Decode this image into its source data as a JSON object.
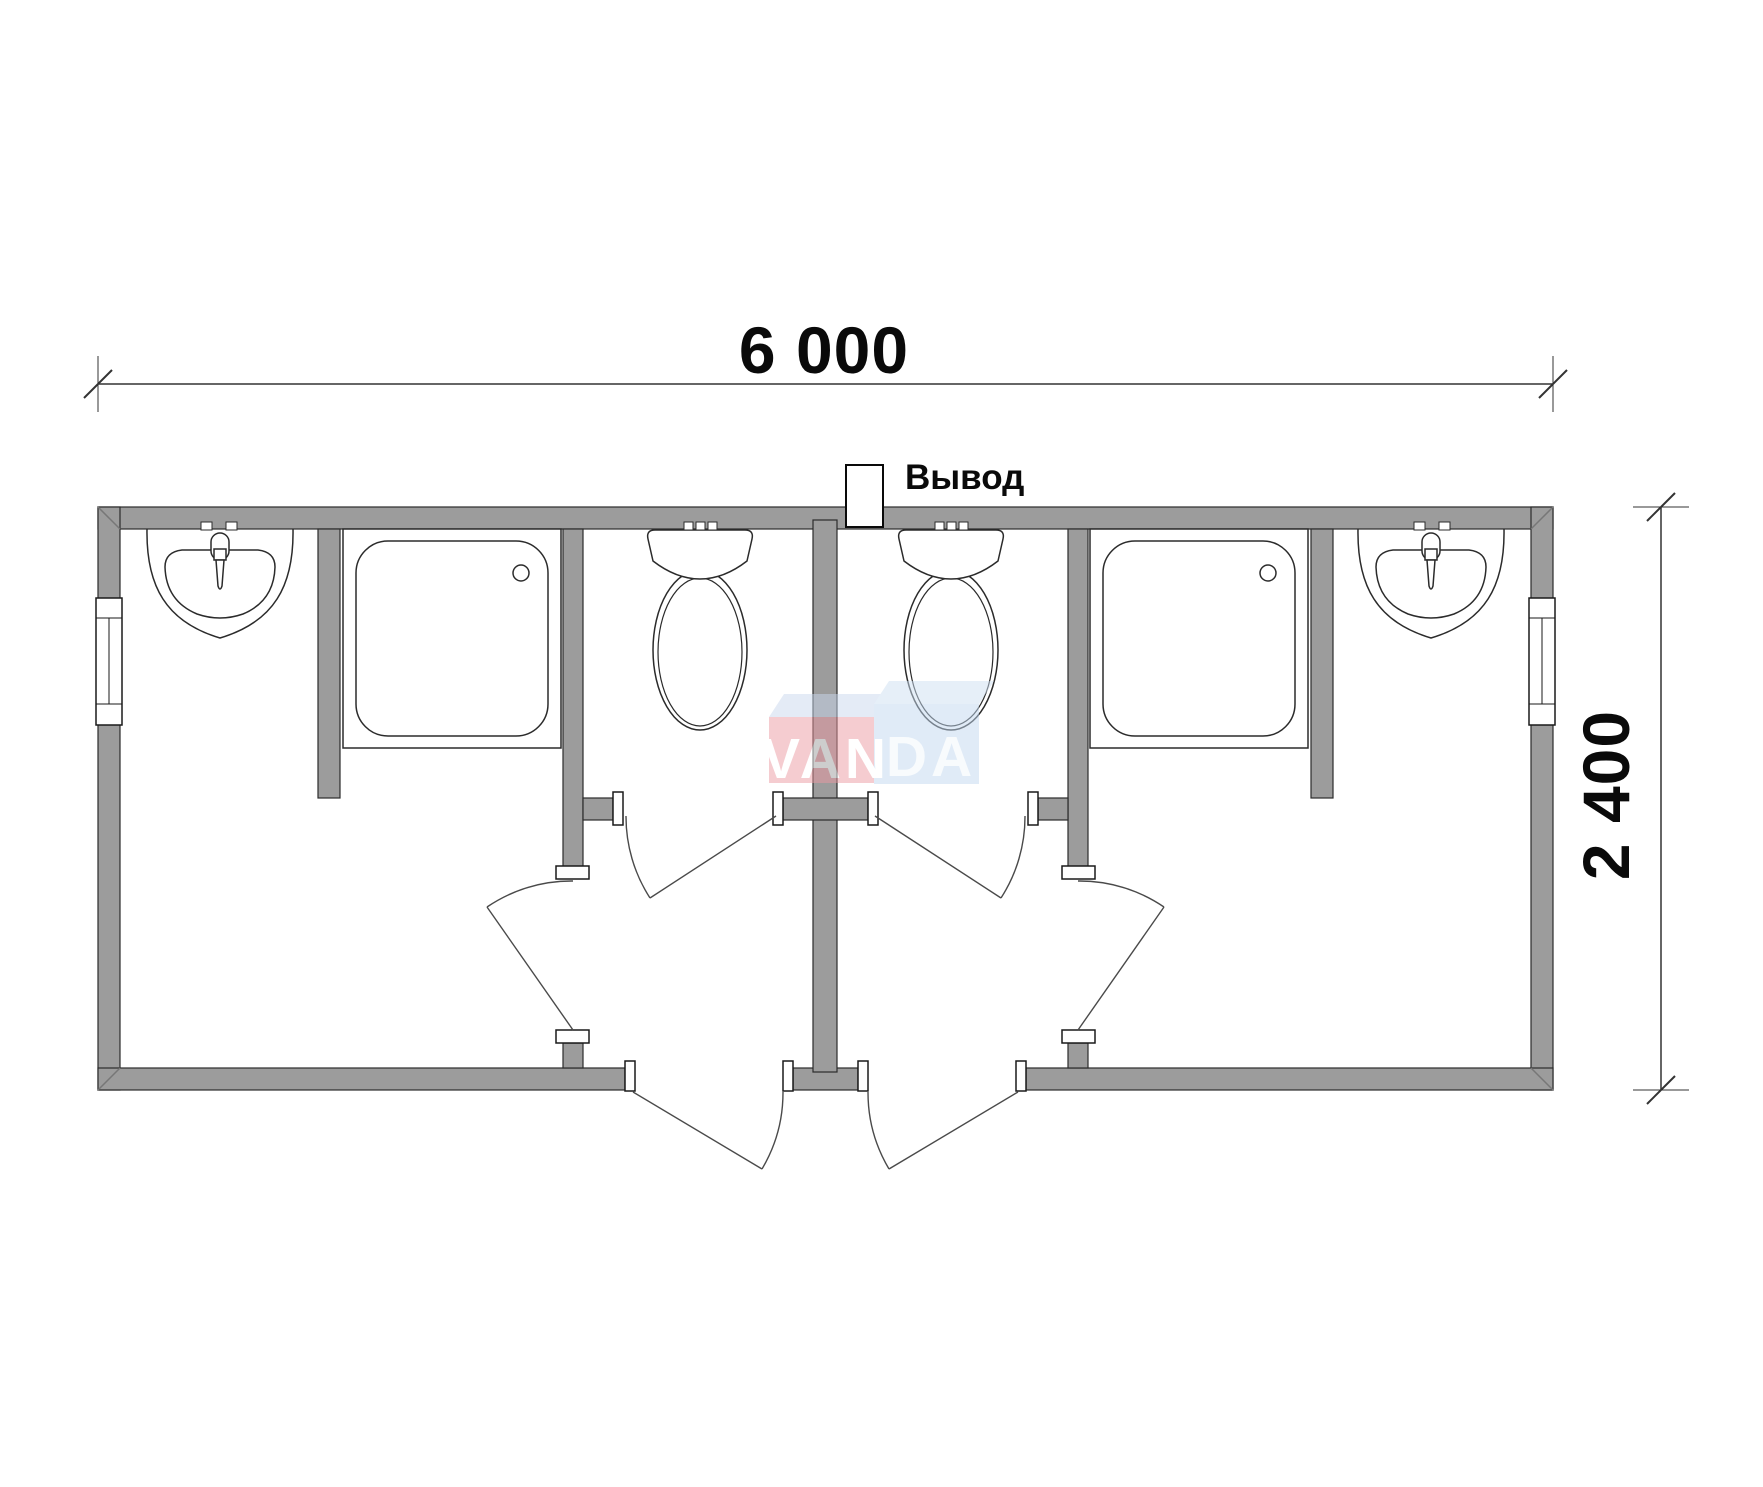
{
  "drawing": {
    "width_dimension": "6 000",
    "height_dimension": "2 400",
    "outlet_label": "Вывод"
  },
  "watermark": {
    "name": "VANDA",
    "part1": "VAN",
    "part2": "DA",
    "pink_face": "#ED9AA2",
    "blue_face": "#C3D9F0",
    "top_left_face": "#CAD8EE",
    "top_right_face": "#CFE0F3",
    "text_color": "#FFFFFF",
    "text_color_2": "#F3F8FD"
  },
  "colors": {
    "wall_fill": "#9C9C9C",
    "outline": "#2B2B2B",
    "fixture_line": "#2B2B2B",
    "door_line": "#4A4A4A",
    "dimension_line": "#333333",
    "background": "#FFFFFF"
  },
  "fixtures": {
    "washbasin_count": 2,
    "shower_tray_count": 2,
    "toilet_count": 2,
    "window_count": 2,
    "door_count": 6
  }
}
